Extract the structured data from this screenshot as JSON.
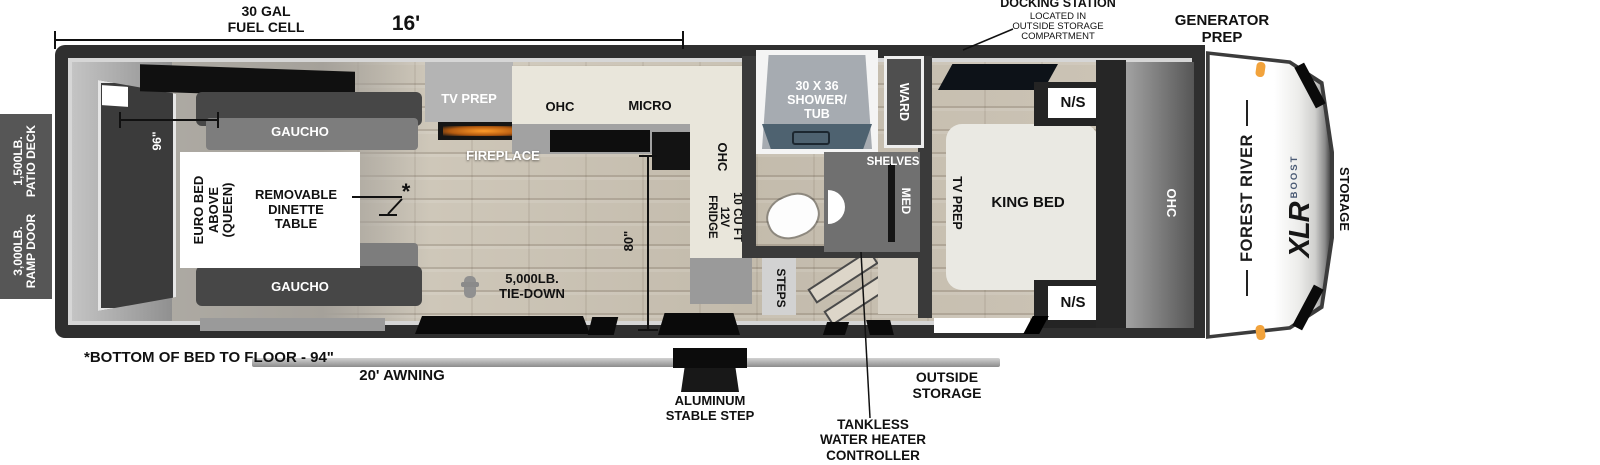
{
  "exterior_top": {
    "fuel_cell": "30 GAL\nFUEL CELL",
    "length": "16'",
    "docking_title": "DOCKING STATION",
    "docking_sub": "LOCATED IN\nOUTSIDE STORAGE\nCOMPARTMENT",
    "generator_prep": "GENERATOR\nPREP"
  },
  "exterior_left": {
    "patio_deck": "1,500LB.\nPATIO DECK",
    "ramp_door": "3,000LB.\nRAMP DOOR"
  },
  "exterior_bottom": {
    "bed_to_floor_note": "*BOTTOM OF BED TO FLOOR - 94\"",
    "awning": "20' AWNING",
    "stable_step": "ALUMINUM\nSTABLE STEP",
    "tankless_controller": "TANKLESS\nWATER HEATER\nCONTROLLER",
    "outside_storage": "OUTSIDE\nSTORAGE"
  },
  "garage": {
    "width": "96\"",
    "gaucho_top": "GAUCHO",
    "gaucho_bottom": "GAUCHO",
    "euro_bed": "EURO BED\nABOVE\n(QUEEN)",
    "dinette_table": "REMOVABLE\nDINETTE\nTABLE",
    "bed_height_marker": "*"
  },
  "kitchen": {
    "tv_prep": "TV PREP",
    "fireplace": "FIREPLACE",
    "ohc": "OHC",
    "micro": "MICRO",
    "ohc_side": "OHC",
    "fridge": "10 CU FT\n12V\nFRIDGE",
    "height": "80\"",
    "tie_down": "5,000LB.\nTIE-DOWN"
  },
  "bathroom": {
    "shower": "30 X 36\nSHOWER/\nTUB",
    "shelves": "SHELVES",
    "med": "MED",
    "steps": "STEPS"
  },
  "bedroom": {
    "ward": "WARD",
    "tv_prep": "TV PREP",
    "king_bed": "KING BED",
    "ns_top": "N/S",
    "ns_bottom": "N/S",
    "ohc": "OHC"
  },
  "front_cap": {
    "brand": "FOREST RIVER",
    "model": "XLR",
    "series": "BOOST",
    "storage": "STORAGE"
  },
  "colors": {
    "wall": "#2f2f2f",
    "floor_wood": "#c9c1b3",
    "counter_cream": "#e9e6db",
    "tub_edge": "#4e6270",
    "marker_light_orange": "#f2a33c",
    "label_black": "#111111",
    "label_white": "#ffffff"
  }
}
